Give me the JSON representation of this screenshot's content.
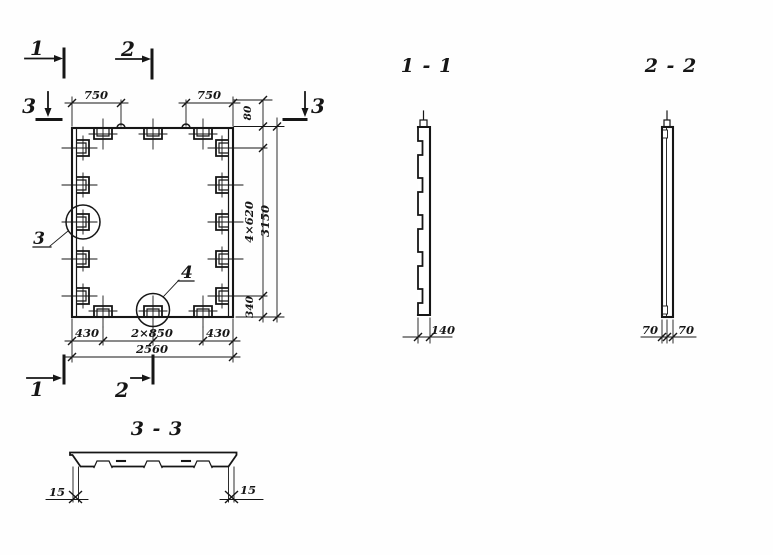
{
  "plan": {
    "marker1": "1",
    "marker2": "2",
    "marker3": "3",
    "detail3": "3",
    "detail4": "4",
    "dims": {
      "top_left_750": "750",
      "top_right_750": "750",
      "edge_80": "80",
      "side_4x620": "4×620",
      "side_340": "340",
      "total_height_3150": "3150",
      "bottom_left_430": "430",
      "bottom_mid_2x850": "2×850",
      "bottom_right_430": "430",
      "total_width_2560": "2560"
    }
  },
  "section_1_1": {
    "title": "1 - 1",
    "thickness_140": "140"
  },
  "section_2_2": {
    "title": "2 - 2",
    "ply_left_70": "70",
    "ply_right_70": "70"
  },
  "section_3_3": {
    "title": "3 - 3",
    "offset_left_15": "15",
    "offset_right_15": "15"
  }
}
